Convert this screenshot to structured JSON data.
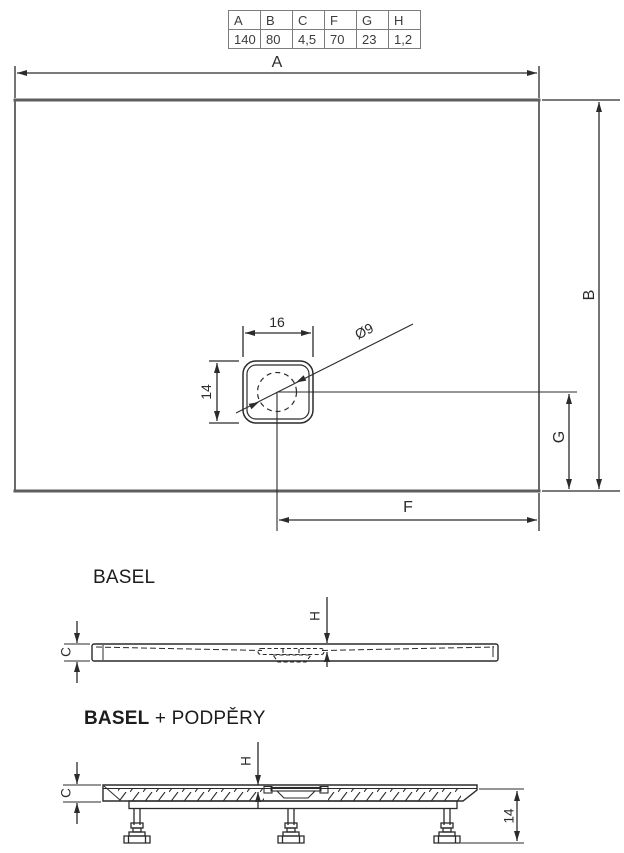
{
  "dimension_table": {
    "headers": [
      "A",
      "B",
      "C",
      "F",
      "G",
      "H"
    ],
    "values": [
      "140",
      "80",
      "4,5",
      "70",
      "23",
      "1,2"
    ]
  },
  "plan_view": {
    "width_label": "A",
    "height_label": "B",
    "drain_offset_bottom_label": "F",
    "drain_offset_side_label": "G",
    "drain_width": "16",
    "drain_height": "14",
    "drain_diameter": "Ø9"
  },
  "side_view": {
    "title": "BASEL",
    "thickness_label": "C",
    "depth_label": "H"
  },
  "support_view": {
    "title_product": "BASEL",
    "title_suffix": " + PODPĚRY",
    "thickness_label": "C",
    "depth_label": "H",
    "leg_height": "14"
  },
  "colors": {
    "line": "#2b2b2b",
    "thick_edge": "#5e5e5e",
    "table_border": "#7d7d7d",
    "table_text": "#3c3c3c"
  }
}
